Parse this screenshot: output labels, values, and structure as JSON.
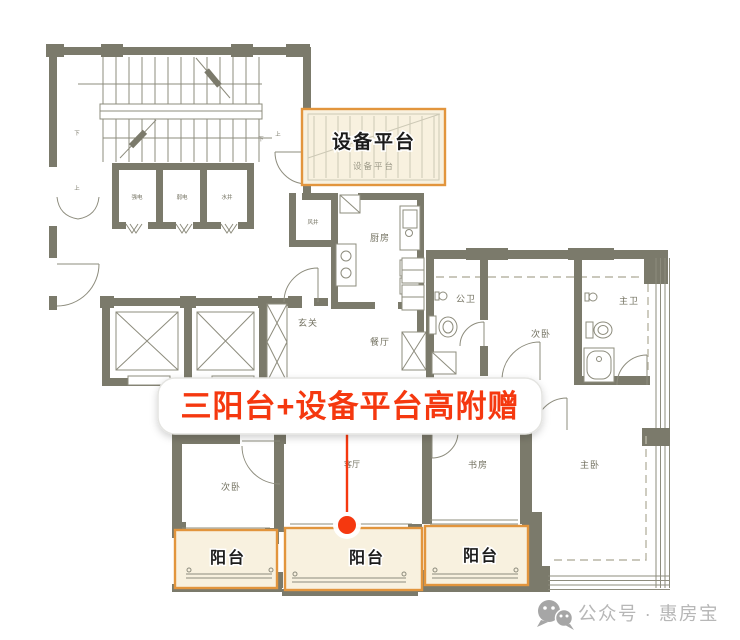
{
  "colors": {
    "wall": "#7b7a6b",
    "line": "#8d8c7d",
    "hatch": "#cdc9b6",
    "dash": "#b9b6a6",
    "cream": "#f8f1df",
    "orange": "#e2953d",
    "red": "#f5380f",
    "label": "#72705f",
    "ink": "#1c1c1c",
    "watermark": "#b7b7b7",
    "wmicon": "#a6a6a6"
  },
  "banner": {
    "text": "三阳台+设备平台高附赠"
  },
  "equipment_platform": {
    "title": "设备平台",
    "subtitle": "设备平台"
  },
  "balconies": {
    "b1": "阳台",
    "b2": "阳台",
    "b3": "阳台"
  },
  "rooms": {
    "kitchen": "厨房",
    "air_shaft": "风井",
    "entry": "玄关",
    "dining": "餐厅",
    "living": "客厅",
    "bedroom_top": "次卧",
    "bedroom_bottom": "次卧",
    "study": "书房",
    "master": "主卧",
    "bath_public": "公卫",
    "bath_master": "主卫"
  },
  "utility_shafts": {
    "strong": "强电",
    "weak": "弱电",
    "water": "水井"
  },
  "stairs": {
    "up": "上",
    "down": "下"
  },
  "watermark": {
    "icon": "wechat-icon",
    "text": "公众号 · 惠房宝"
  }
}
